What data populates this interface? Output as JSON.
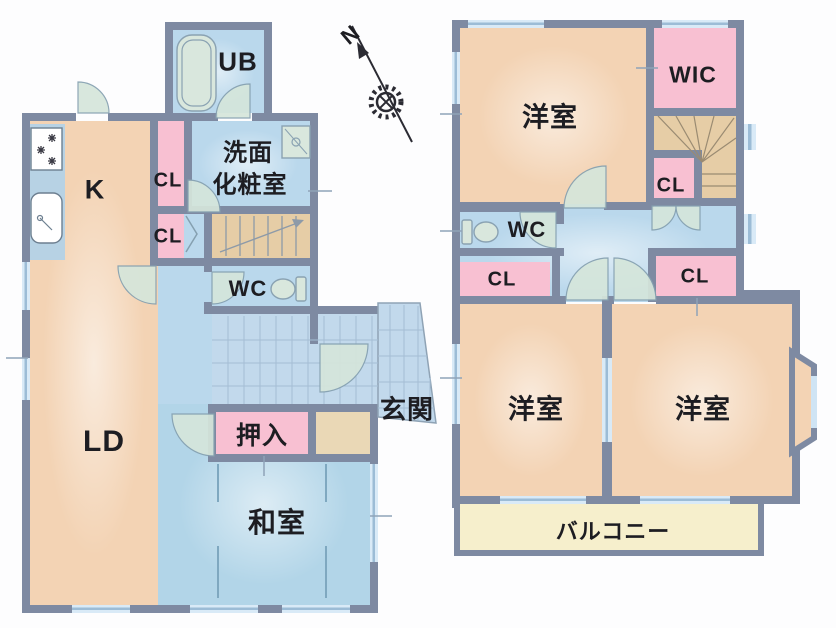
{
  "title": "floor-plan",
  "compass": {
    "north_label": "N"
  },
  "floor1": {
    "ub_label": "UB",
    "washroom_label_line1": "洗面",
    "washroom_label_line2": "化粧室",
    "kitchen_label": "K",
    "closet_upper_label": "CL",
    "closet_lower_label": "CL",
    "wc_label": "WC",
    "living_dining_label": "LD",
    "entrance_label": "玄関",
    "oshiire_label": "押入",
    "japanese_room_label": "和室"
  },
  "floor2": {
    "bedroom_nw_label": "洋室",
    "wic_label": "WIC",
    "stair_closet_label": "CL",
    "wc_label": "WC",
    "closet_west_label": "CL",
    "closet_east_label": "CL",
    "bedroom_sw_label": "洋室",
    "bedroom_se_label": "洋室",
    "balcony_label": "バルコニー"
  },
  "colors": {
    "wall": "#7e8aa2",
    "peach": "#f3d3b4",
    "pink": "#f8c0d2",
    "blue": "#bad8ec",
    "tile": "#c2d9ec",
    "tatami": "#b2d5e8",
    "tan": "#e6cda6",
    "tan2": "#ead8b6",
    "cream": "#f6efcc",
    "counter": "#b7d2e4",
    "door": "#d5e6db",
    "line": "#8fa3b8",
    "ink": "#1d1d22"
  }
}
